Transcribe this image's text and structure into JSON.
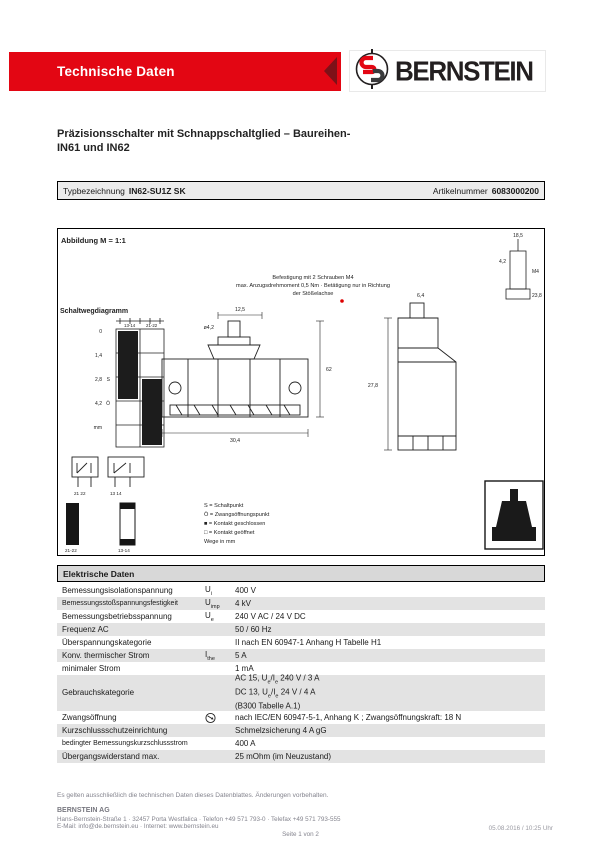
{
  "header": {
    "banner": "Technische Daten",
    "brand": "BERNSTEIN"
  },
  "title": {
    "line1": "Präzisionsschalter mit Schnappschaltglied – Baureihen-",
    "line2": "IN61 und IN62"
  },
  "type_row": {
    "label": "Typbezeichnung",
    "value": "IN62-SU1Z SK",
    "article_label": "Artikelnummer",
    "article_value": "6083000200"
  },
  "drawing": {
    "caption": "Abbildung M = 1:1",
    "notes": [
      "Befestigung mit 2 Schrauben M4",
      "max. Anzugsdrehmoment 0,5 Nm · Betätigung nur in Richtung",
      "der Stößelachse"
    ],
    "travel_label": "Schaltwegdiagramm",
    "grid_headers": [
      "13-14",
      "21-22"
    ],
    "scale": [
      "0",
      "1,4",
      "2,8",
      "4,2",
      "mm"
    ],
    "marks": [
      "S",
      "Ö"
    ],
    "contacts": [
      "21  22",
      "13  14"
    ],
    "bars": [
      "21-22",
      "13-14"
    ],
    "legend": [
      "S = Schaltpunkt",
      "Ö = Zwangsöffnungspunkt",
      "■ = Kontakt geschlossen",
      "□ = Kontakt geöffnet",
      "Wege in mm"
    ],
    "dims": [
      "12,5",
      "62",
      "30,4",
      "ø4,2",
      "27,8",
      "6,4",
      "4,2",
      "M4",
      "18,5",
      "23,8"
    ]
  },
  "table": {
    "title": "Elektrische Daten",
    "rows": [
      {
        "label": "Bemessungsisolationspannung",
        "sym": {
          "base": "U",
          "sub": "i"
        },
        "icon": null,
        "shaded": false,
        "small": false,
        "lines": [
          [
            {
              "t": "400 V"
            }
          ]
        ]
      },
      {
        "label": "Bemessungsstoßspannungsfestigkeit",
        "sym": {
          "base": "U",
          "sub": "imp"
        },
        "icon": null,
        "shaded": true,
        "small": true,
        "lines": [
          [
            {
              "t": "4 kV"
            }
          ]
        ]
      },
      {
        "label": "Bemessungsbetriebsspannung",
        "sym": {
          "base": "U",
          "sub": "e"
        },
        "icon": null,
        "shaded": false,
        "small": false,
        "lines": [
          [
            {
              "t": "240 V AC / 24 V DC"
            }
          ]
        ]
      },
      {
        "label": "Frequenz AC",
        "sym": null,
        "icon": null,
        "shaded": true,
        "small": false,
        "lines": [
          [
            {
              "t": "50 / 60 Hz"
            }
          ]
        ]
      },
      {
        "label": "Überspannungskategorie",
        "sym": null,
        "icon": null,
        "shaded": false,
        "small": false,
        "lines": [
          [
            {
              "t": "II nach EN 60947-1 Anhang H Tabelle H1"
            }
          ]
        ]
      },
      {
        "label": "Konv. thermischer Strom",
        "sym": {
          "base": "I",
          "sub": "the"
        },
        "icon": null,
        "shaded": true,
        "small": false,
        "lines": [
          [
            {
              "t": "5 A"
            }
          ]
        ]
      },
      {
        "label": "minimaler Strom",
        "sym": null,
        "icon": null,
        "shaded": false,
        "small": false,
        "lines": [
          [
            {
              "t": "1 mA"
            }
          ]
        ]
      },
      {
        "label": "Gebrauchskategorie",
        "sym": null,
        "icon": null,
        "shaded": true,
        "small": false,
        "lines": [
          [
            {
              "t": "AC 15, U"
            },
            {
              "s": "e"
            },
            {
              "t": "/I"
            },
            {
              "s": "e"
            },
            {
              "t": " 240 V / 3 A"
            }
          ],
          [
            {
              "t": "DC 13, U"
            },
            {
              "s": "e"
            },
            {
              "t": "/I"
            },
            {
              "s": "e"
            },
            {
              "t": " 24 V / 4 A"
            }
          ],
          [
            {
              "t": "(B300 Tabelle A.1)"
            }
          ]
        ]
      },
      {
        "label": "Zwangsöffnung",
        "sym": null,
        "icon": "positive-opening-icon",
        "shaded": false,
        "small": false,
        "lines": [
          [
            {
              "t": "nach IEC/EN 60947-5-1, Anhang K ; Zwangsöffnungskraft: 18 N"
            }
          ]
        ]
      },
      {
        "label": "Kurzschlussschutzeinrichtung",
        "sym": null,
        "icon": null,
        "shaded": true,
        "small": false,
        "lines": [
          [
            {
              "t": "Schmelzsicherung 4 A gG"
            }
          ]
        ]
      },
      {
        "label": "bedingter Bemessungskurzschlussstrom",
        "sym": null,
        "icon": null,
        "shaded": false,
        "small": true,
        "lines": [
          [
            {
              "t": "400 A"
            }
          ]
        ]
      },
      {
        "label": "Übergangswiderstand max.",
        "sym": null,
        "icon": null,
        "shaded": true,
        "small": false,
        "lines": [
          [
            {
              "t": "25 mOhm (im Neuzustand)"
            }
          ]
        ]
      }
    ]
  },
  "footer": {
    "note": "Es gelten ausschließlich die technischen Daten dieses Datenblattes. Änderungen vorbehalten.",
    "company": "BERNSTEIN AG",
    "address": "Hans-Bernstein-Straße 1 · 32457 Porta Westfalica · Telefon +49 571 793-0 · Telefax +49 571 793-555",
    "contact": "E-Mail: info@de.bernstein.eu · Internet: www.bernstein.eu",
    "page": "Seite 1 von 2",
    "generated": "05.08.2016 / 10:25 Uhr"
  },
  "colors": {
    "brand_red": "#e30613",
    "band_gray": "#e3e3e3",
    "head_gray": "#d8d8d8",
    "footer_gray": "#84848e"
  }
}
